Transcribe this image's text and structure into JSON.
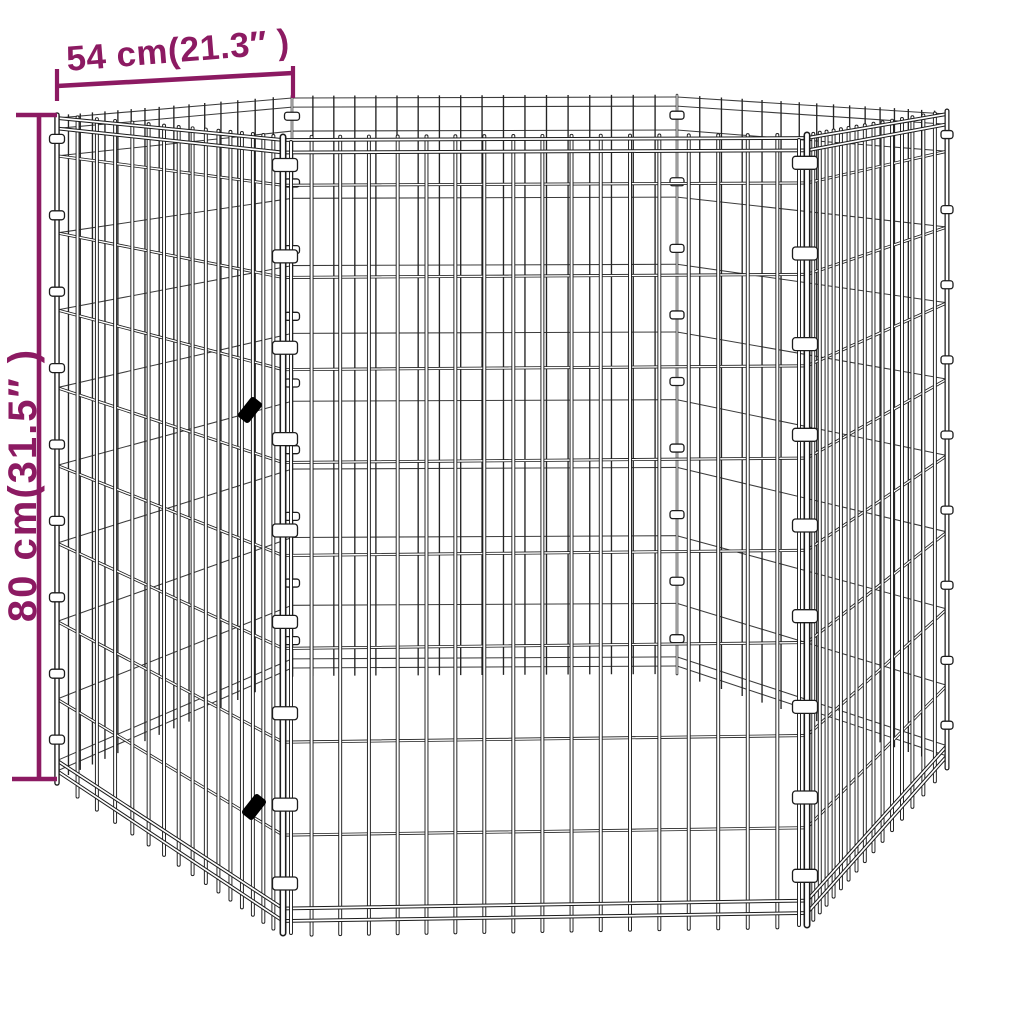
{
  "page": {
    "background": "#ffffff"
  },
  "diagram": {
    "kind": "product-dimension-diagram",
    "product": "6-panel hexagonal wire mesh pet playpen",
    "accent_color": "#8c1a62",
    "wire_color": "#1c1c1c",
    "far_wire_color": "#3c3c3c",
    "clip_fill": "#ffffff",
    "latch_color": "#000000",
    "panel_count": 6,
    "bars_per_panel": 17,
    "bars_per_side_panel": 15,
    "wire_rows": 8,
    "clips_per_post": 9,
    "width_dim": {
      "label": "54 cm(21.3″ )",
      "cm": 54,
      "inches": 21.3
    },
    "height_dim": {
      "label": "80 cm(31.5″ )",
      "cm": 80,
      "inches": 31.5
    }
  }
}
